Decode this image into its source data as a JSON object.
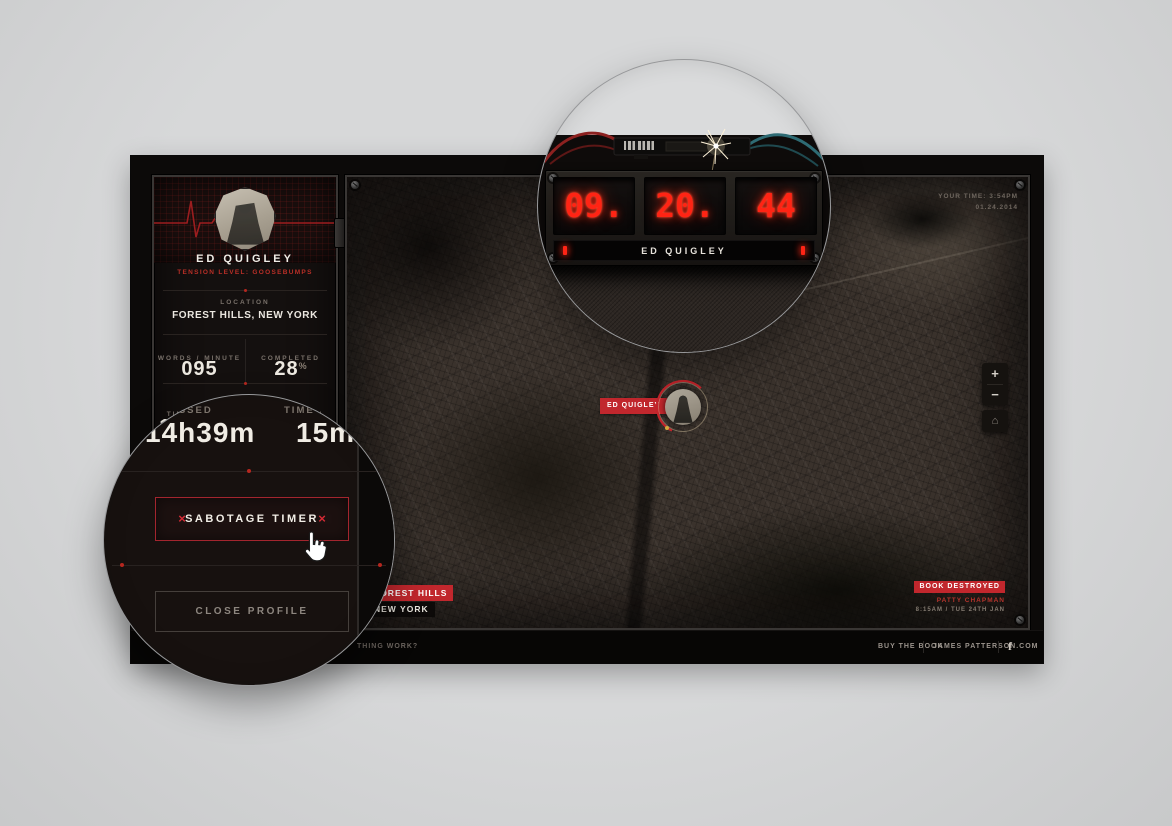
{
  "profile": {
    "name": "ED QUIGLEY",
    "tension": "TENSION LEVEL: GOOSEBUMPS",
    "location_label": "LOCATION",
    "location_value": "FOREST HILLS, NEW YORK",
    "wpm_label": "WORDS / MINUTE",
    "wpm_value": "095",
    "completed_label": "COMPLETED",
    "completed_value": "28",
    "completed_unit": "%",
    "time_passed_label": "TIME PASSED",
    "time_passed_value": "14h39m",
    "time_stolen_label": "TIME STOLEN",
    "time_stolen_value": "15m",
    "sabotage_label": "SABOTAGE TIMER",
    "sabotage_x": "×",
    "close_label": "CLOSE PROFILE"
  },
  "detonator": {
    "digits": [
      "09.",
      "20.",
      "44"
    ],
    "label": "ED QUIGLEY"
  },
  "map": {
    "your_time": "YOUR TIME: 3:54PM",
    "your_date": "01.24.2014",
    "marker_label": "ED QUIGLEY",
    "zoom_in": "+",
    "zoom_out": "−",
    "home": "⌂",
    "city_badge_line1": "FOREST HILLS",
    "city_badge_line2": "NEW YORK",
    "event_badge": "BOOK DESTROYED",
    "event_name": "PATTY CHAPMAN",
    "event_time": "8:15AM / TUE 24TH JAN"
  },
  "footer": {
    "help": "THING WORK?",
    "buy": "BUY THE BOOK",
    "site": "JAMES PATTERSON.COM",
    "facebook": "f"
  },
  "colors": {
    "accent_red": "#c1272d",
    "digit_red": "#ff2414",
    "background_gray": "#d2d3d4"
  }
}
